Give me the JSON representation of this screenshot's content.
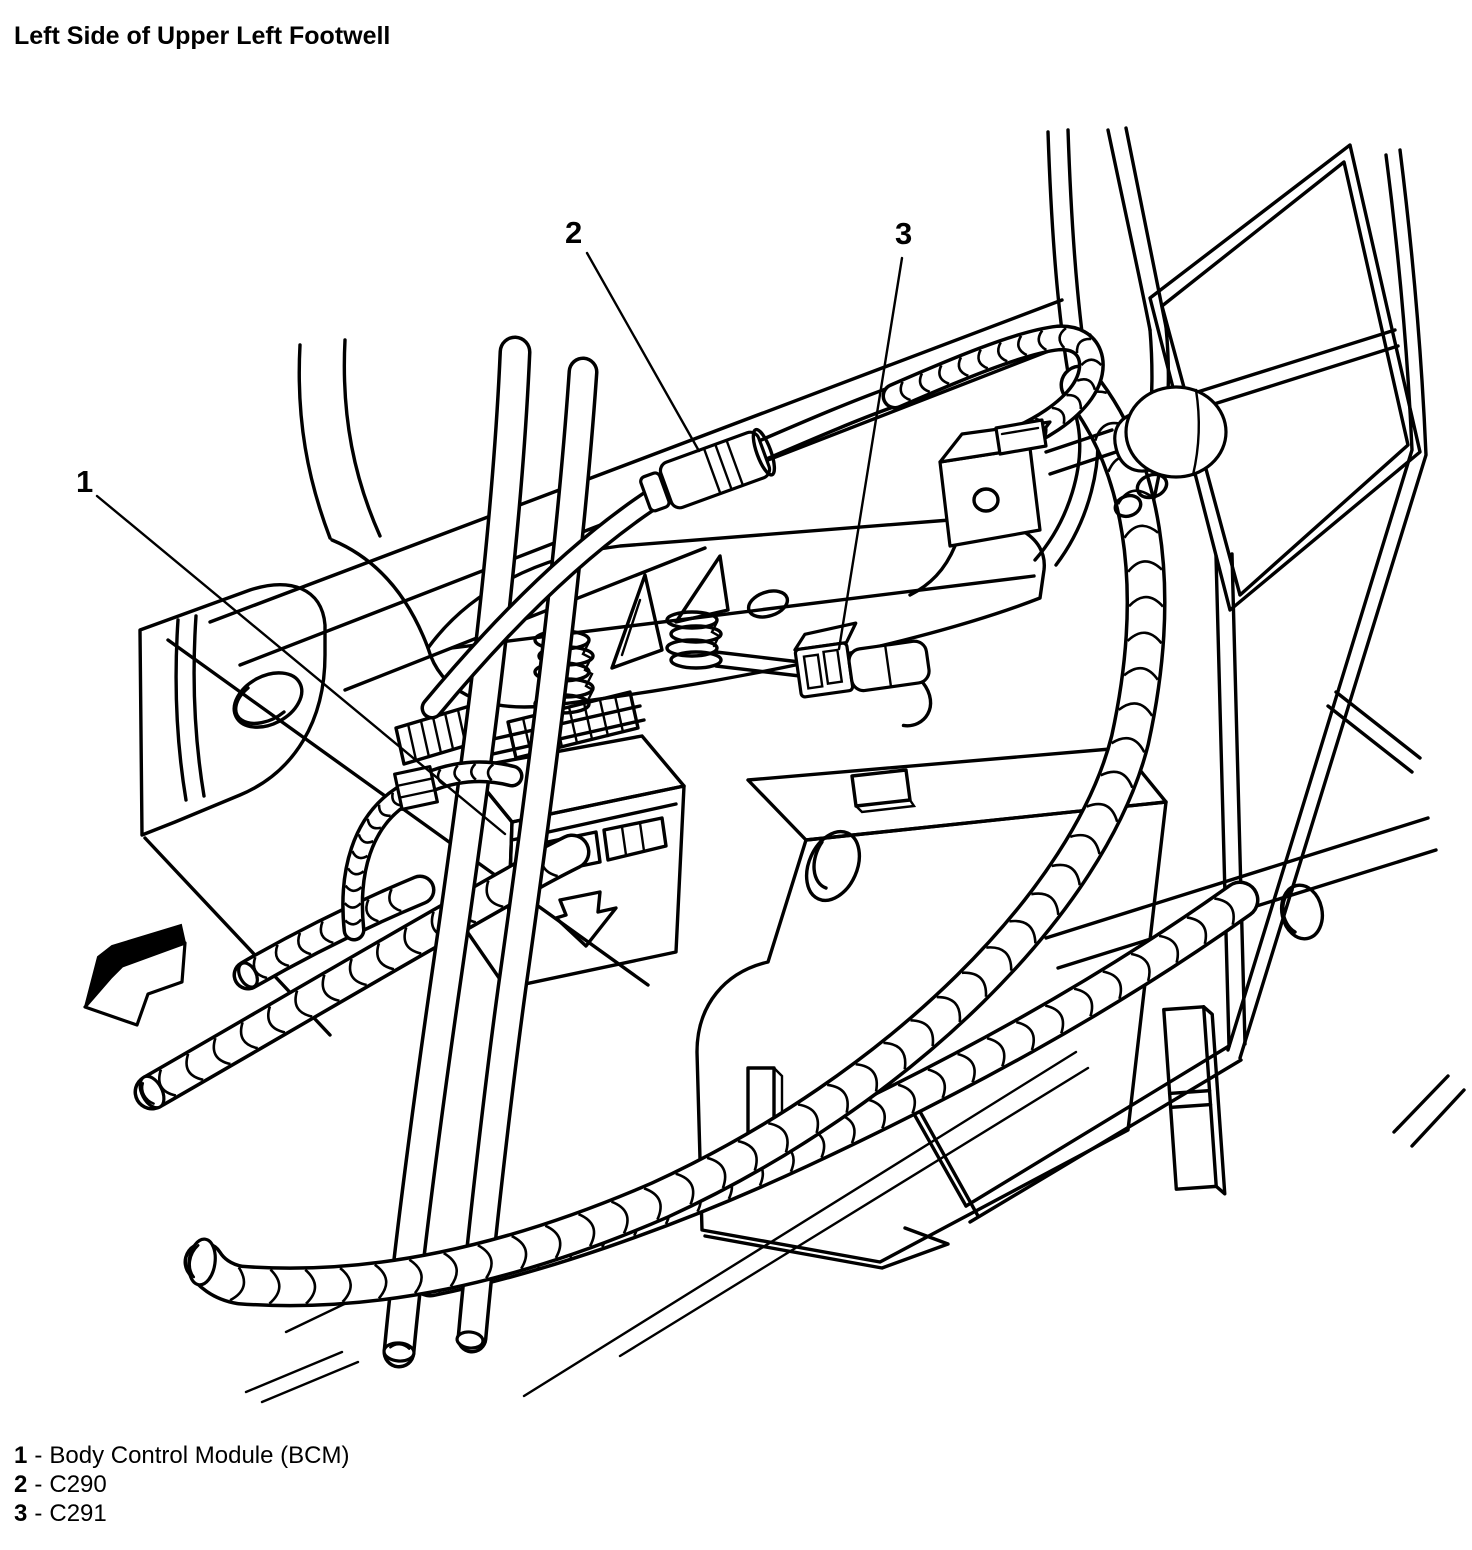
{
  "colors": {
    "background": "#ffffff",
    "ink": "#000000"
  },
  "header": {
    "title": "Left Side of Upper Left Footwell"
  },
  "callouts": [
    {
      "number": "1",
      "target": "Body Control Module (BCM)"
    },
    {
      "number": "2",
      "target": "C290"
    },
    {
      "number": "3",
      "target": "C291"
    }
  ],
  "legend": {
    "separator": "-",
    "items": [
      {
        "number": "1",
        "label": "Body Control Module (BCM)"
      },
      {
        "number": "2",
        "label": "C290"
      },
      {
        "number": "3",
        "label": "C291"
      }
    ]
  }
}
